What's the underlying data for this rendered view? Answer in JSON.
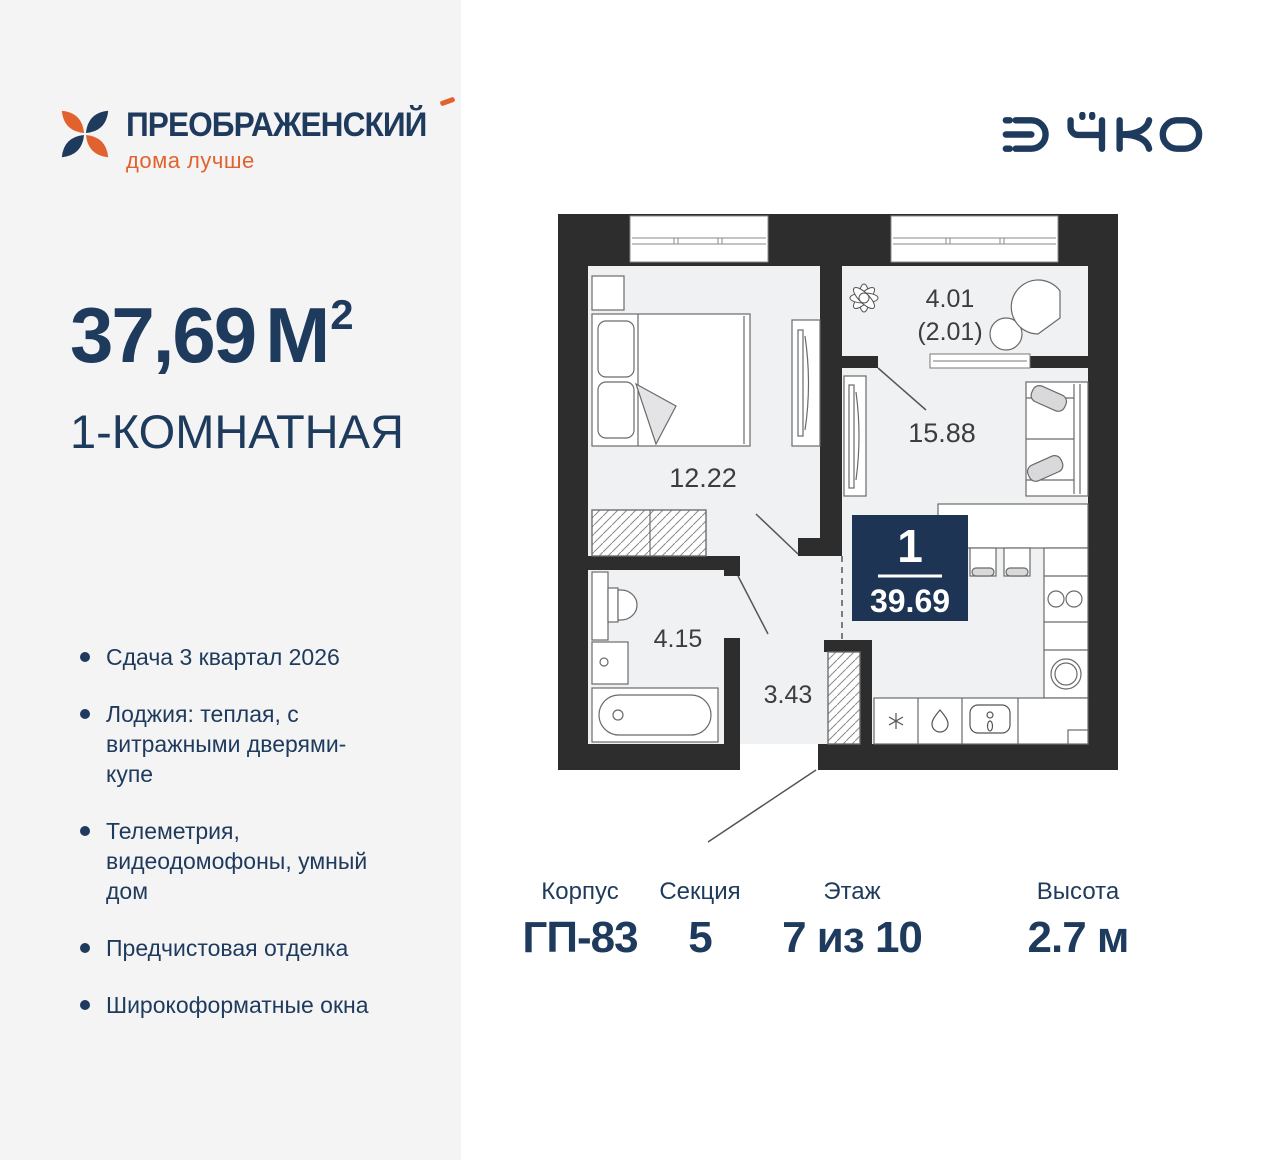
{
  "colors": {
    "navy_text": "#1E3A5C",
    "orange_accent": "#E2622F",
    "badge_navy": "#1D3454",
    "wall_dark": "#2D2D2D",
    "floor_fill": "#F0F1F2",
    "left_panel_bg": "#F4F4F5"
  },
  "brand": {
    "name": "ПРЕОБРАЖЕНСКИЙ",
    "tagline": "дома лучше"
  },
  "developer": {
    "name": "ЭНКО"
  },
  "summary": {
    "area_value": "37,69",
    "area_unit": "М",
    "area_sup": "2",
    "type_label": "1-КОМНАТНАЯ"
  },
  "features": [
    "Сдача 3 квартал 2026",
    "Лоджия: теплая, с витражными дверями-купе",
    "Телеметрия, видеодомофоны, умный дом",
    "Предчистовая отделка",
    "Широкоформатные окна"
  ],
  "plan": {
    "rooms": {
      "bedroom": "12.22",
      "living": "15.88",
      "bathroom": "4.15",
      "hall": "3.43",
      "loggia": "4.01",
      "loggia_reduced": "(2.01)"
    },
    "badge": {
      "rooms_count": "1",
      "total_area": "39.69"
    }
  },
  "specs": [
    {
      "label": "Корпус",
      "value": "ГП-83"
    },
    {
      "label": "Секция",
      "value": "5"
    },
    {
      "label": "Этаж",
      "value": "7 из 10"
    },
    {
      "label": "Высота",
      "value": "2.7 м"
    }
  ]
}
